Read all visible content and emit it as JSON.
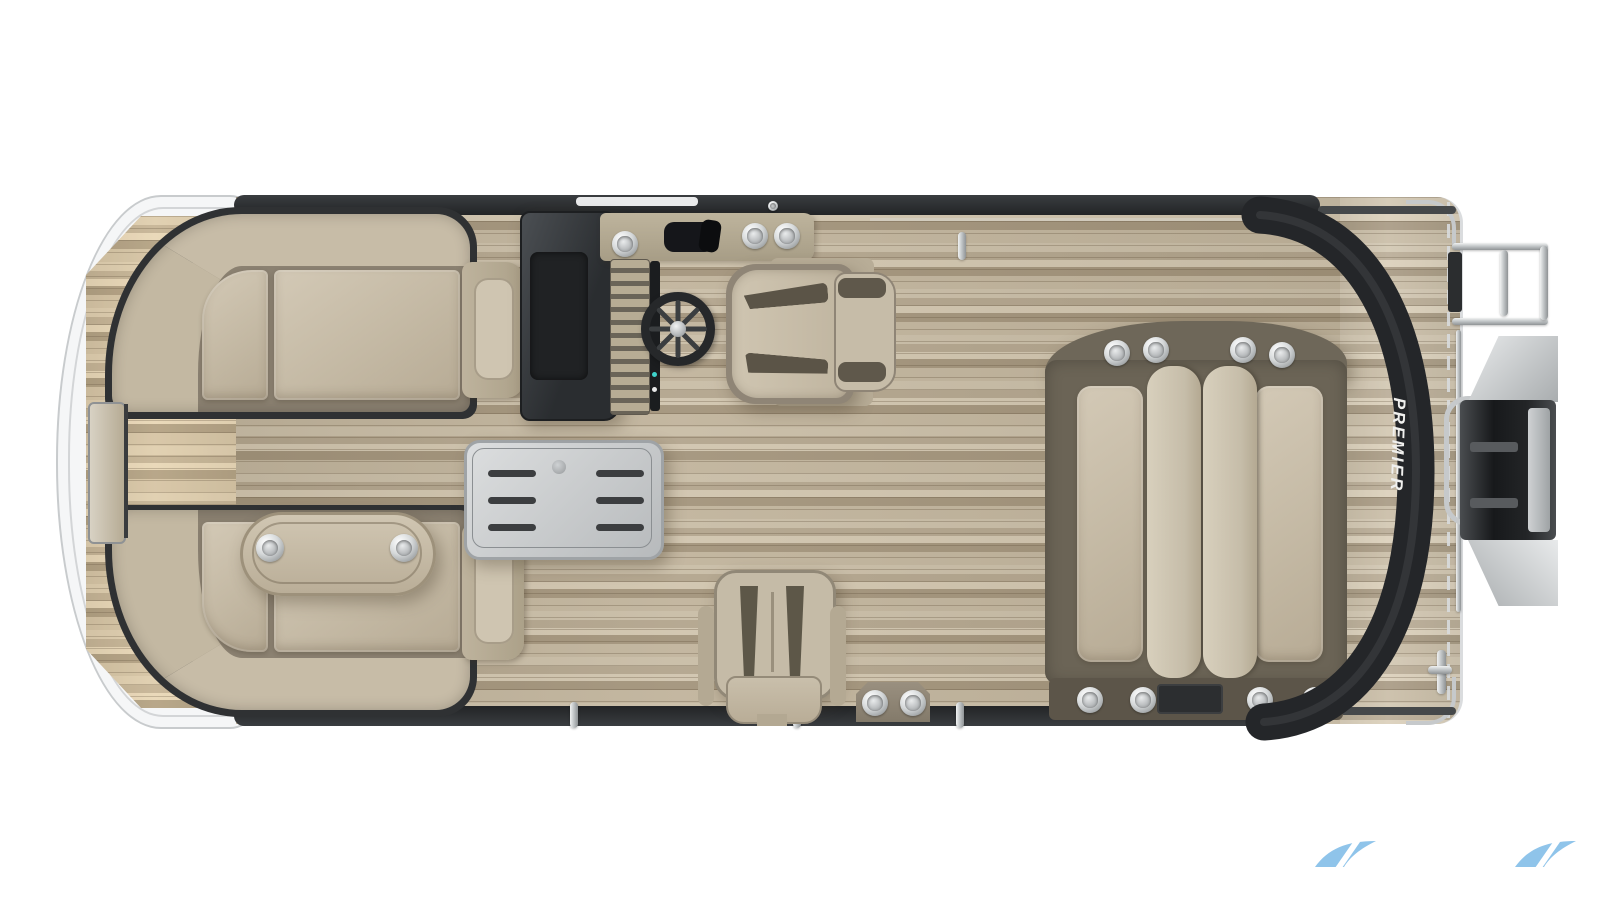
{
  "scene": {
    "type": "pontoon-boat-floorplan-top-view",
    "background": "#ffffff"
  },
  "branding": {
    "arch_text": "PREMIER",
    "watermark_icon": "premier-wave-swoosh",
    "watermark_color": "#8fc4ea"
  },
  "palette": {
    "deck_wood": "#b7aa92",
    "bow_wood": "#c2a685",
    "upholstery": "#c9bfab",
    "upholstery_base": "#8b8171",
    "stern_frame": "#6b6456",
    "console_dark": "#303336",
    "arch_black": "#242629",
    "chrome": "#d7dadc",
    "hull_white": "#f5f6f7"
  },
  "parts": {
    "bow_lounge_port": "bow-lounge",
    "bow_lounge_starboard": "bow-lounge",
    "armrest_table": "oval-armrest-cupholders",
    "center_table": "cocktail-table",
    "helm": "helm-console-steering",
    "captain_chair": "captains-chair",
    "companion_chair": "companion-chair",
    "stern_loungers": "dual-stern-loungers",
    "outboard_motor": "outboard-motor",
    "boarding_ladder": "stern-ladder"
  }
}
